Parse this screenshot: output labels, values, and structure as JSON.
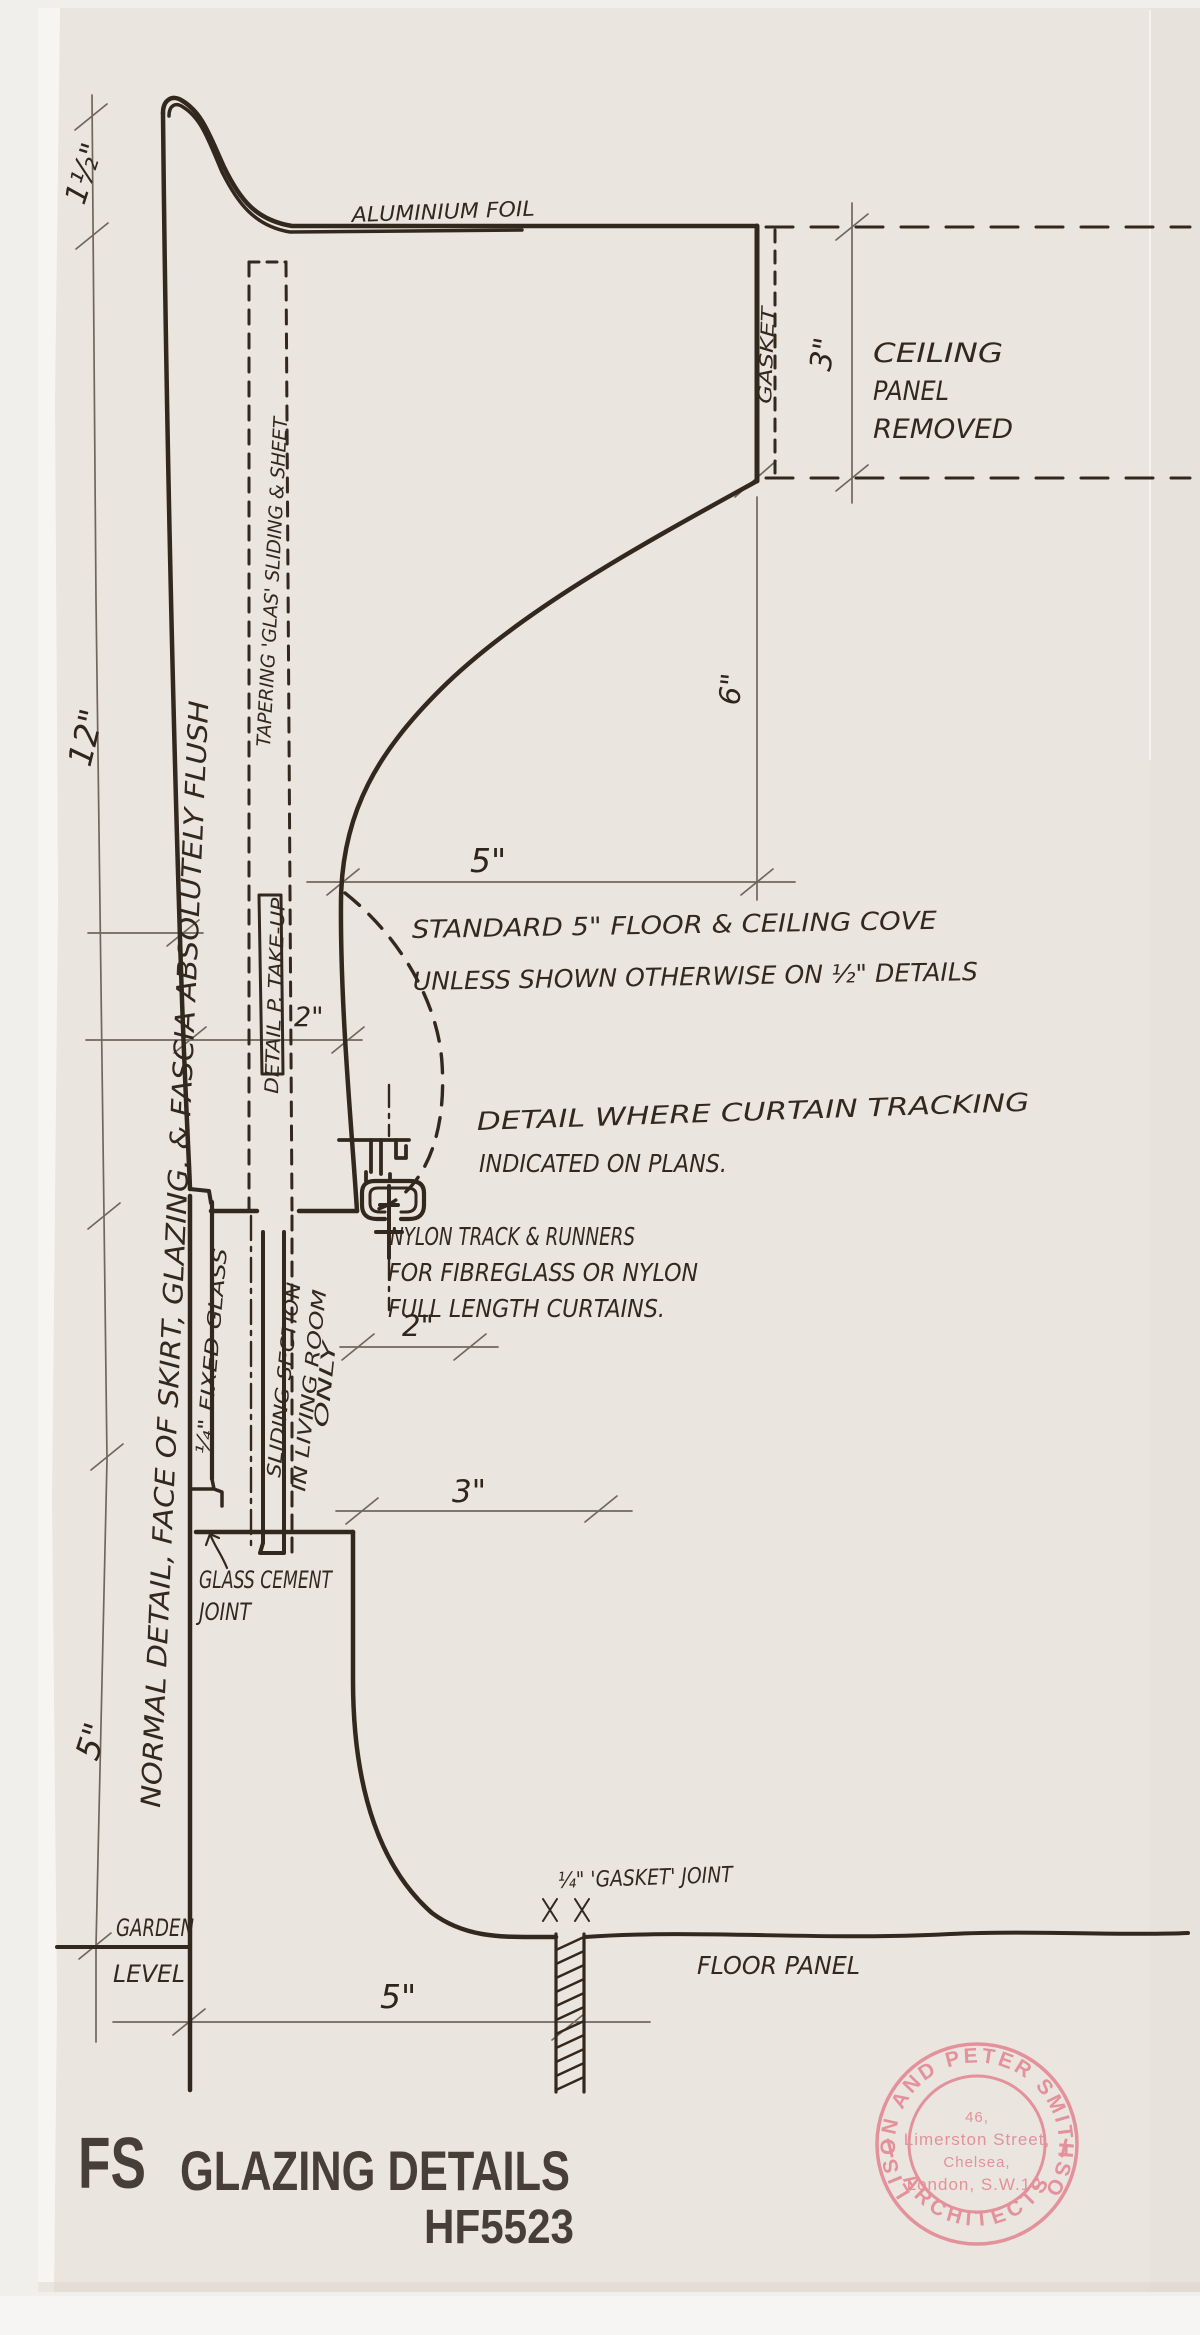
{
  "colors": {
    "paper": "#ebe5df",
    "background": "#f1efec",
    "ink": "#33281e",
    "pencil": "#70675c",
    "stamp": "#e2838e",
    "title_ink": "#2b211a"
  },
  "labels": {
    "aluminium_foil": "ALUMINIUM FOIL",
    "gasket_vertical": "GASKET",
    "ceiling_panel": [
      "CEILING",
      "PANEL",
      "REMOVED"
    ],
    "floor_panel": "FLOOR PANEL",
    "garden": "GARDEN",
    "level": "LEVEL",
    "fixed_glass": "¼\" FIXED GLASS",
    "sliding_section": [
      "SLIDING SECTION",
      "IN LIVING ROOM",
      "ONLY"
    ],
    "tapering_sheet": "TAPERING 'GLAS' SLIDING & SHEET",
    "detail_p_takeup": "DETAIL P. TAKE-UP",
    "normal_detail": "NORMAL DETAIL, FACE OF SKIRT, GLAZING, & FASCIA ABSOLUTELY FLUSH",
    "glass_cement": [
      "GLASS CEMENT",
      "JOINT"
    ],
    "gasket_joint": "¼\" 'GASKET' JOINT"
  },
  "notes": {
    "standard_cove": [
      "STANDARD 5\" FLOOR & CEILING COVE",
      "UNLESS SHOWN OTHERWISE ON ½\" DETAILS"
    ],
    "curtain_detail": [
      "DETAIL WHERE CURTAIN TRACKING",
      "INDICATED ON PLANS."
    ],
    "nylon_track": [
      "NYLON TRACK & RUNNERS",
      "FOR FIBREGLASS OR NYLON",
      "FULL LENGTH CURTAINS."
    ]
  },
  "dimensions": {
    "fascia_height": "1½\"",
    "wall_height": "12\"",
    "lower_wall": "5\"",
    "ceiling_gap": "3\"",
    "cove_width": "5\"",
    "cove_rise": "6\"",
    "fascia_depth": "2\"",
    "track_offset": "2\"",
    "skirt_depth": "3\"",
    "floor_width": "5\""
  },
  "title": {
    "series": "FS",
    "name": "GLAZING DETAILS",
    "number": "HF5523"
  },
  "stamp": {
    "arc_top": "ALISON AND PETER SMITHSON",
    "arc_bottom": "ARCHITECTS",
    "address": [
      "46,",
      "Limerston Street,",
      "Chelsea,",
      "London, S.W.10."
    ]
  }
}
